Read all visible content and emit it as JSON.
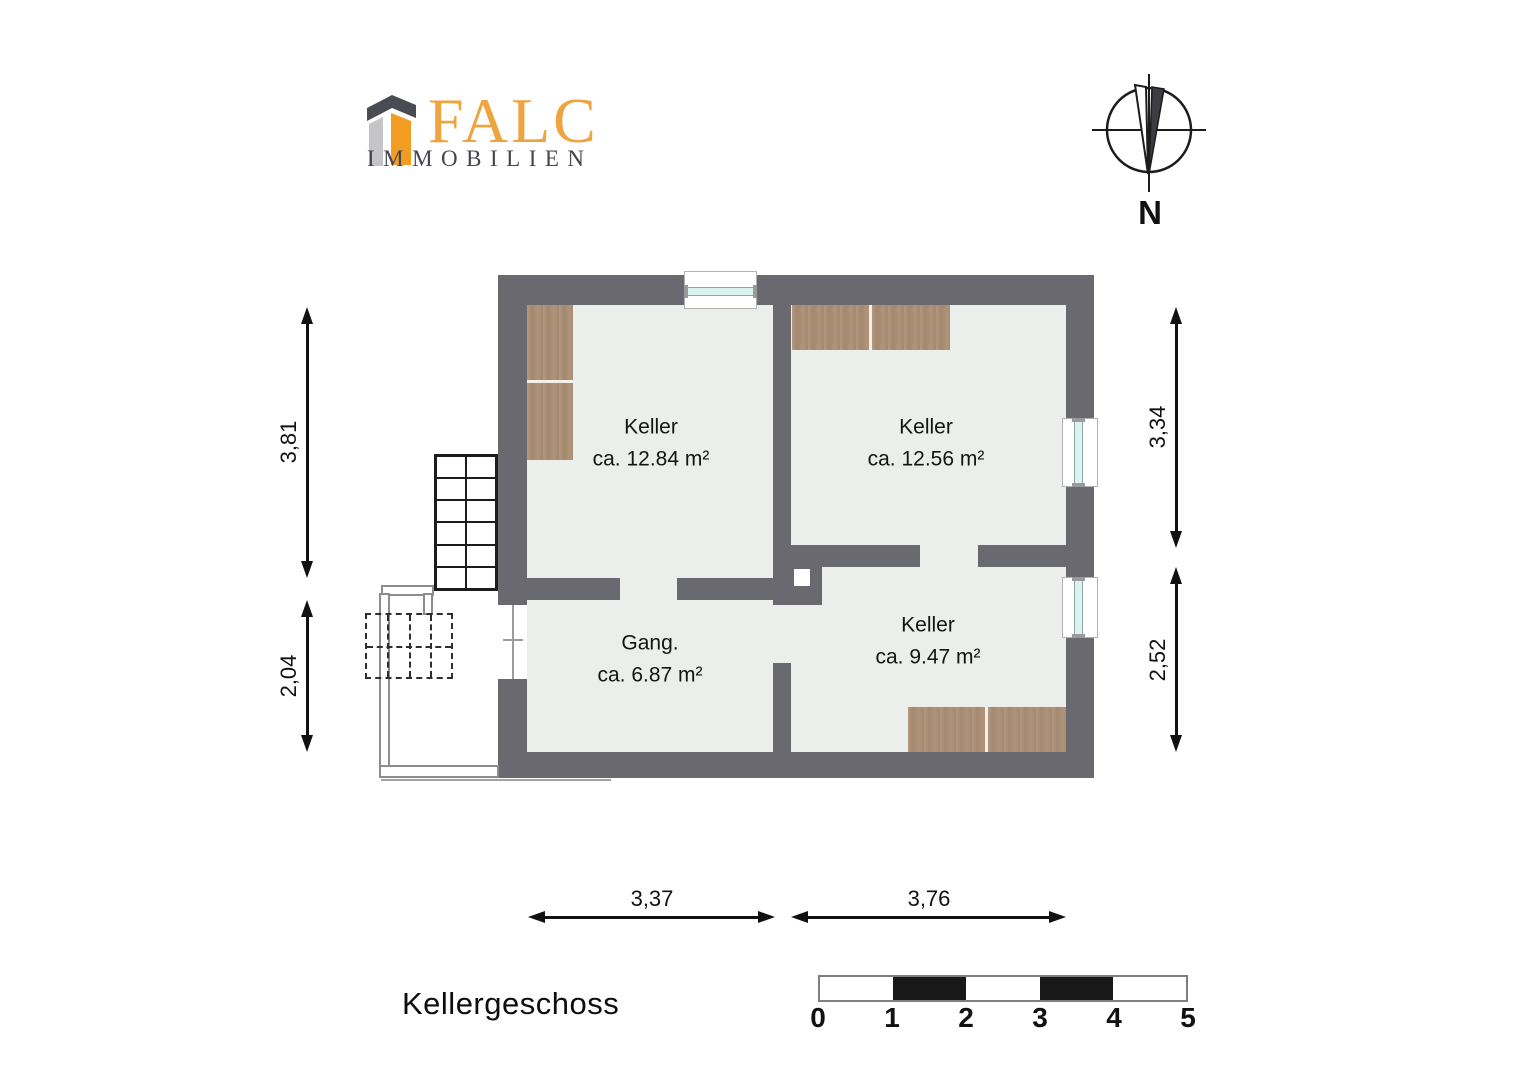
{
  "logo": {
    "brand": "FALC",
    "subtitle": "IMMOBILIEN"
  },
  "compass": {
    "north_label": "N"
  },
  "plan": {
    "rooms": [
      {
        "name": "Keller",
        "area": "ca. 12.84 m²"
      },
      {
        "name": "Keller",
        "area": "ca. 12.56 m²"
      },
      {
        "name": "Gang.",
        "area": "ca. 6.87 m²"
      },
      {
        "name": "Keller",
        "area": "ca. 9.47 m²"
      }
    ],
    "dimensions": {
      "left_upper": "3,81",
      "left_lower": "2,04",
      "right_upper": "3,34",
      "right_lower": "2,52",
      "bottom_left": "3,37",
      "bottom_right": "3,76"
    },
    "colors": {
      "wall": "#69696f",
      "floor": "#ebeeea",
      "wood": "#aa8e75",
      "window_glass": "#d9f3ee"
    }
  },
  "footer": {
    "title": "Kellergeschoss",
    "scale_labels": [
      "0",
      "1",
      "2",
      "3",
      "4",
      "5"
    ]
  }
}
